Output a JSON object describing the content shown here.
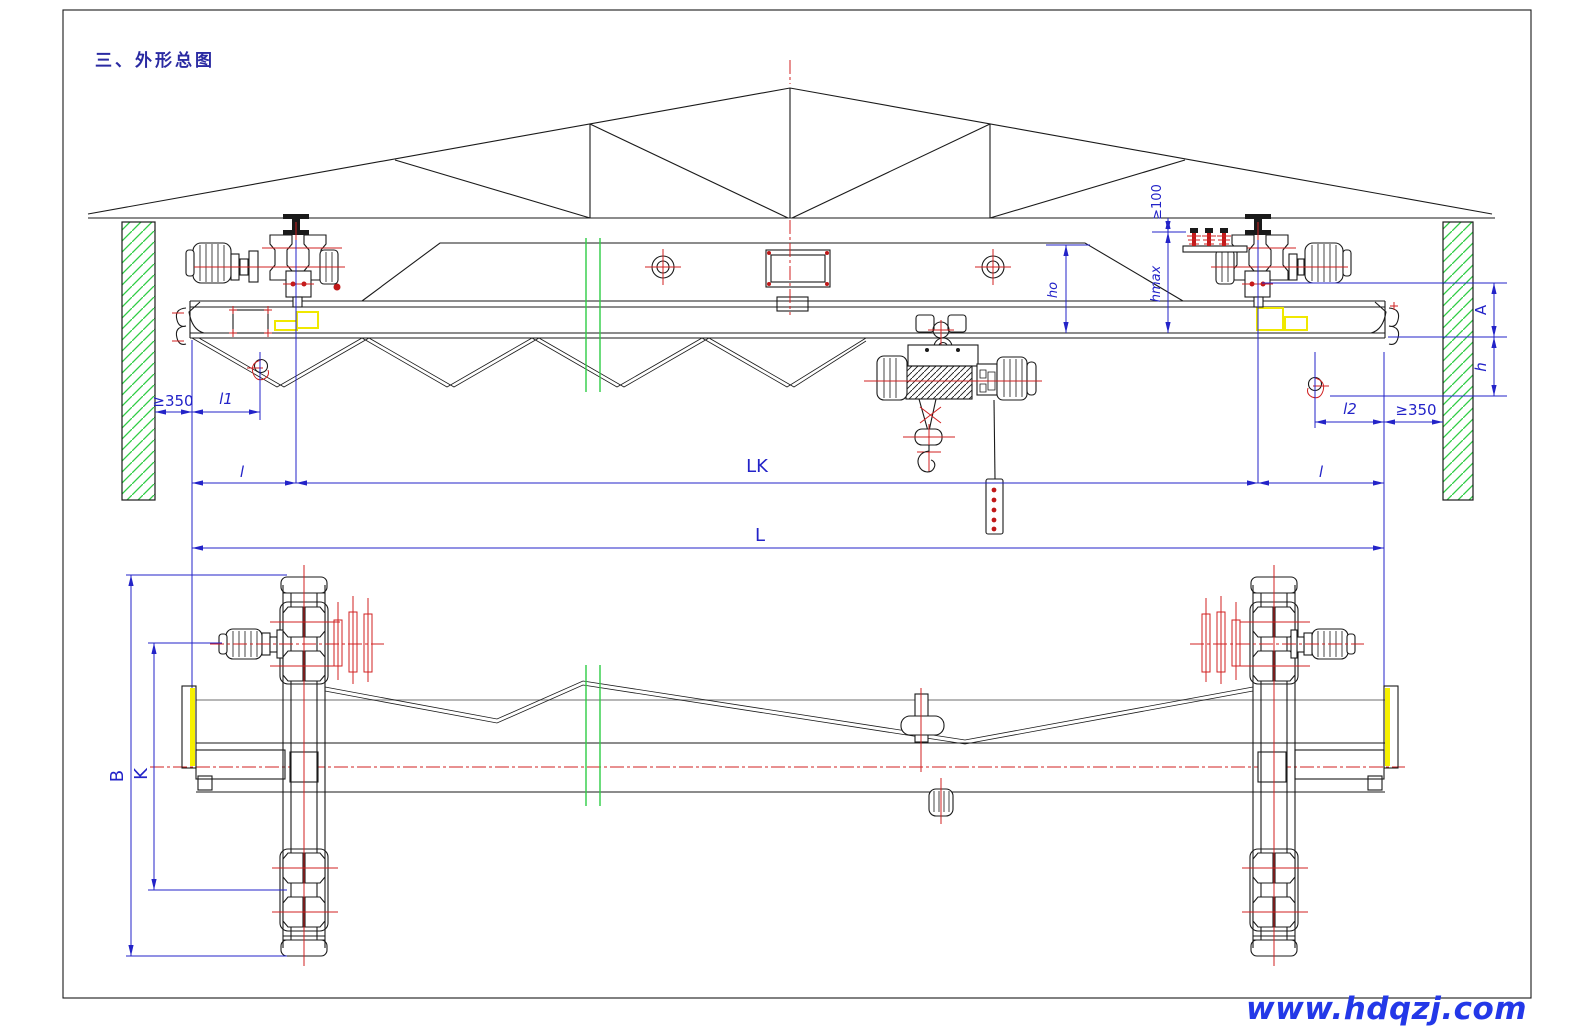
{
  "page": {
    "title": "三、外形总图",
    "watermark": "www.hdqzj.com"
  },
  "colors": {
    "drawing_line": "#1a1a1a",
    "centerline_red": "#d02020",
    "wall_hatch_green": "#2ecc44",
    "dimension_blue": "#2323c8",
    "highlight_yellow": "#f0e800",
    "watermark_blue": "#2338e8",
    "title_blue": "#2a2aa2"
  },
  "front_view": {
    "dims": {
      "clear_left": "≥350",
      "l1": "l1",
      "l_left": "l",
      "lk": "LK",
      "l_right": "l",
      "l2": "l2",
      "clear_right": "≥350",
      "min_headroom": "≥100",
      "hmax": "hmax",
      "ho": "ho",
      "a": "A",
      "h": "h"
    }
  },
  "plan_view": {
    "dims": {
      "l": "L",
      "b": "B",
      "k": "K"
    }
  }
}
